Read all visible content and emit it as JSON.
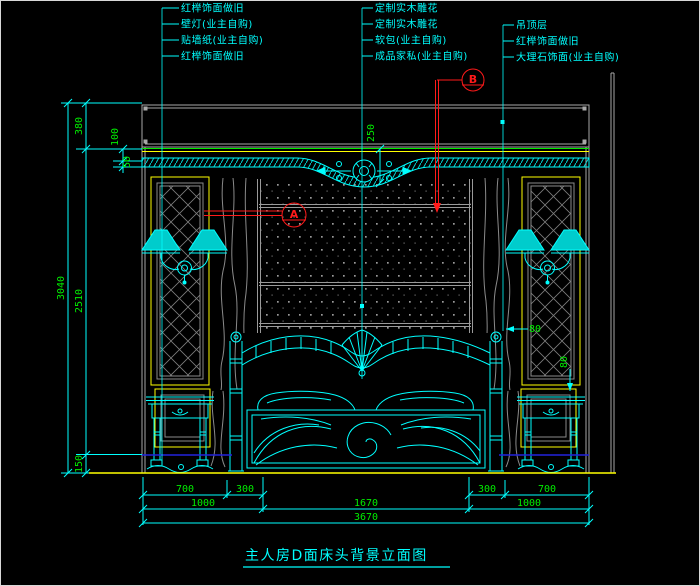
{
  "drawing_title": "主人房D面床头背景立面图",
  "callouts": {
    "left": [
      "红榉饰面做旧",
      "壁灯(业主自购)",
      "贴墙纸(业主自购)",
      "红榉饰面做旧"
    ],
    "middle": [
      "定制实木雕花",
      "定制实木雕花",
      "软包(业主自购)",
      "成品家私(业主自购)"
    ],
    "right": [
      "吊顶层",
      "红榉饰面做旧",
      "大理石饰面(业主自购)"
    ]
  },
  "detail_markers": {
    "a": "A",
    "b": "B"
  },
  "dims": {
    "left": {
      "overall": "3040",
      "top": "380",
      "mid": "2510",
      "bottom": "150",
      "s100": "100",
      "s50": "50"
    },
    "center": {
      "drop": "250"
    },
    "panel": {
      "p1": "80",
      "p2": "80"
    },
    "bottom": {
      "row1": [
        "700",
        "300",
        "300",
        "700"
      ],
      "row2": [
        "1000",
        "1670",
        "1000"
      ],
      "total": "3670"
    }
  },
  "colors": {
    "background": "#000000",
    "line": "#00ffff",
    "dim_text": "#00ee00",
    "frame": "#ffff00",
    "marker": "#ff1a1a",
    "structure": "#a8a8a8",
    "floor_blue": "#2222dd"
  }
}
